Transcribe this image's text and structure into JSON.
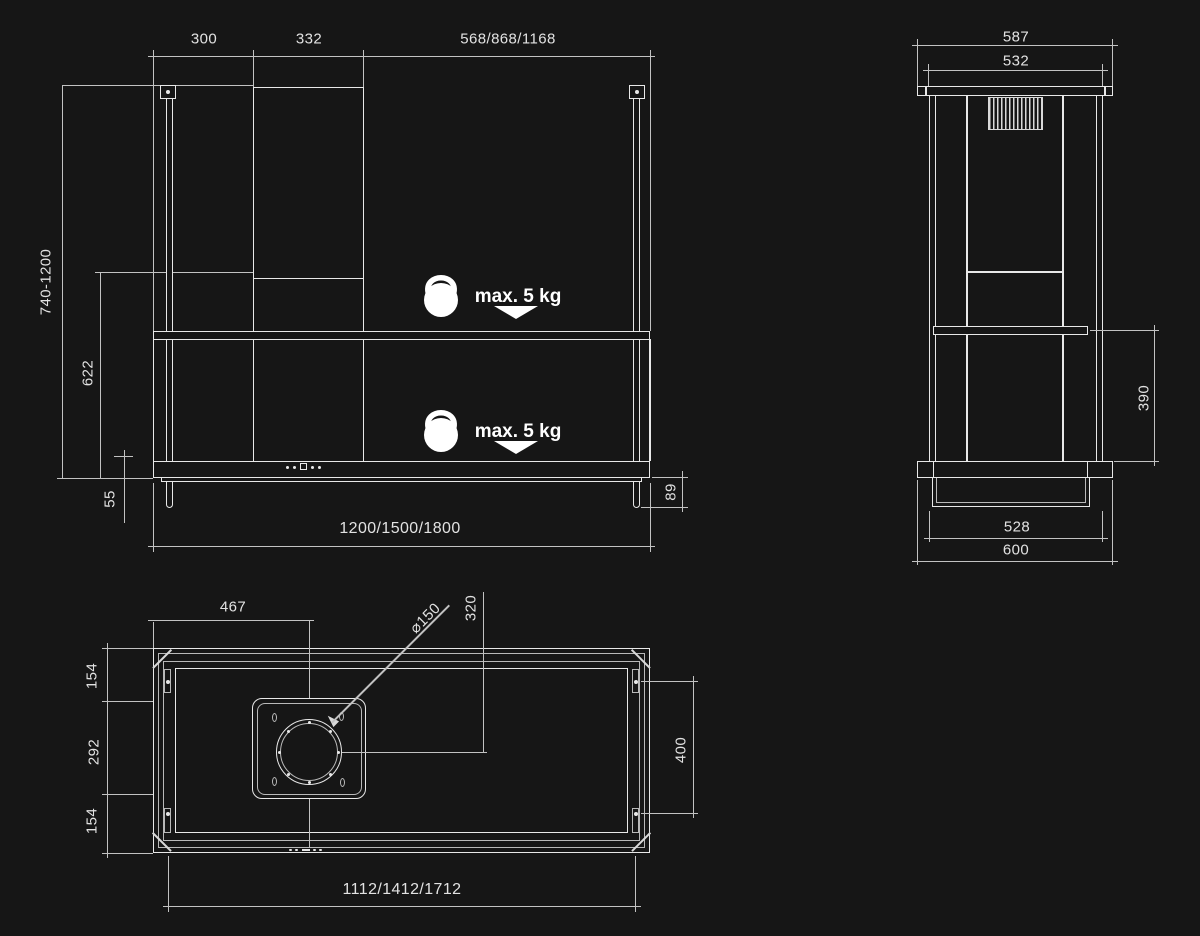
{
  "drawing": {
    "title": "island-hood-installation-dimensions",
    "background_color": "#161616",
    "line_color": "#e8e8e8",
    "dim_line_color": "#c2c2c2",
    "text_color": "#e2e2e2",
    "views": {
      "front": {
        "dims": {
          "offset_left": "300",
          "duct_width": "332",
          "span_right": "568/868/1168",
          "height_range": "740-1200",
          "lower_height": "622",
          "body_height": "55",
          "rod_overhang": "89",
          "total_width": "1200/1500/1800"
        },
        "max_load": "max. 5 kg"
      },
      "side": {
        "dims": {
          "plate_width": "587",
          "hanger_span": "532",
          "clearance": "390",
          "base_span": "528",
          "depth": "600"
        }
      },
      "top": {
        "dims": {
          "duct_offset_left": "467",
          "duct_diameter": "⌀150",
          "duct_offset_back": "320",
          "back_margin": "154",
          "mid_span": "292",
          "front_margin": "154",
          "rod_spacing": "400",
          "panel_width": "1112/1412/1712"
        }
      }
    }
  }
}
